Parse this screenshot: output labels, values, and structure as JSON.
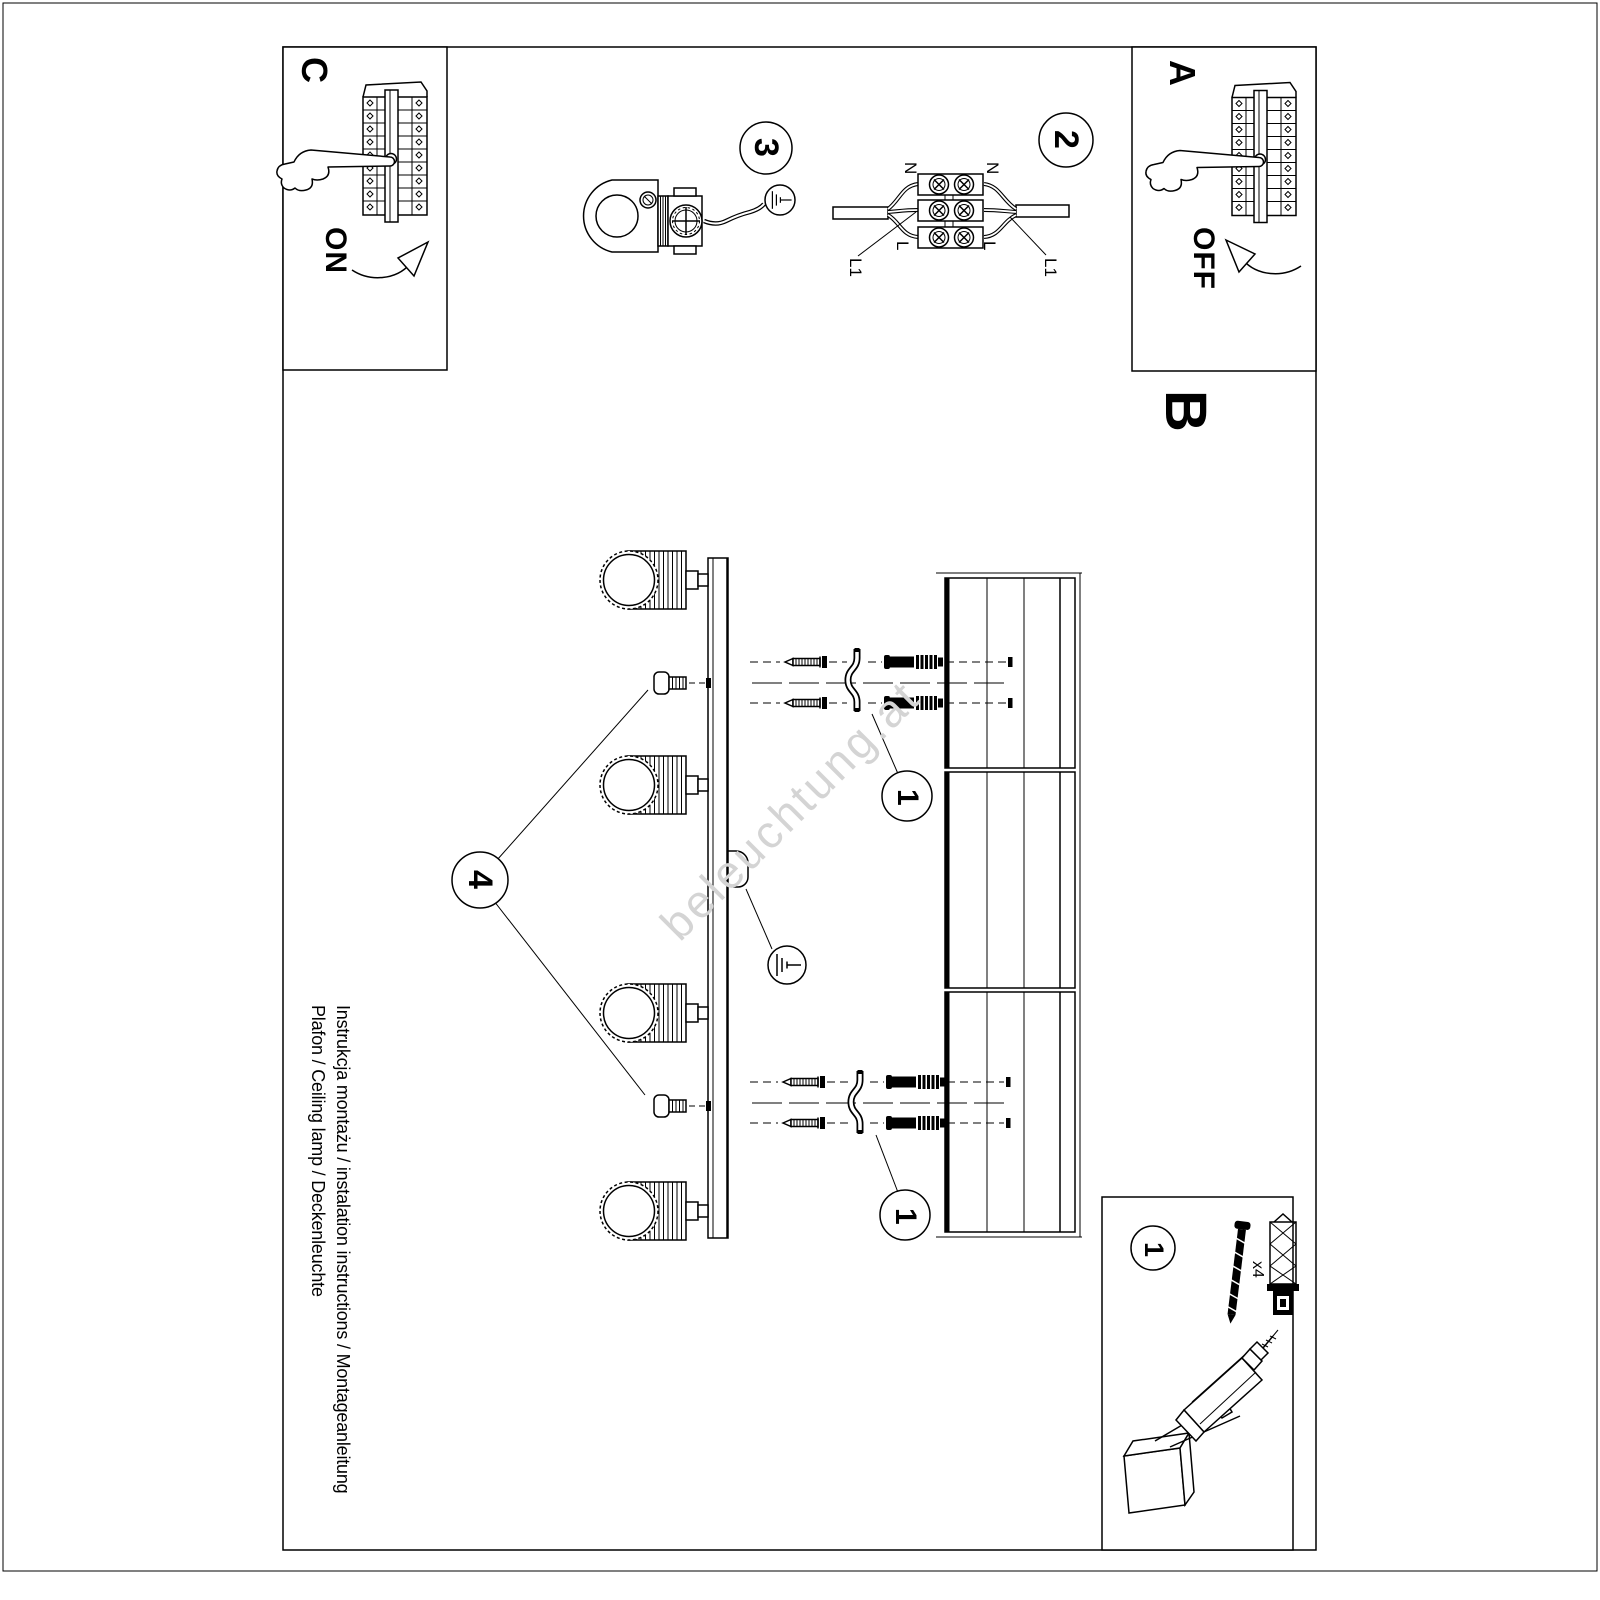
{
  "document": {
    "footer_line1": "Instrukcja montażu / instalation instructions / Montageanleitung",
    "footer_line2": "Plafon / Ceiling lamp / Deckenleuchte",
    "watermark": "beleuchtung.at"
  },
  "sections": {
    "a": {
      "label": "A",
      "switch_action": "OFF"
    },
    "b": {
      "label": "B"
    },
    "c": {
      "label": "C",
      "switch_action": "ON"
    }
  },
  "step_badges": {
    "one": "1",
    "two": "2",
    "three": "3",
    "four": "4"
  },
  "wiring_labels": {
    "neutral_left": "N",
    "neutral_right": "N",
    "line_left": "L",
    "line_right": "L",
    "l1_left": "L1",
    "l1_right": "L1"
  },
  "parts_box": {
    "badge": "1",
    "screw_quantity": "x4"
  },
  "colors": {
    "ink": "#000000",
    "paper": "#ffffff",
    "watermark": "#d4d4d4"
  }
}
